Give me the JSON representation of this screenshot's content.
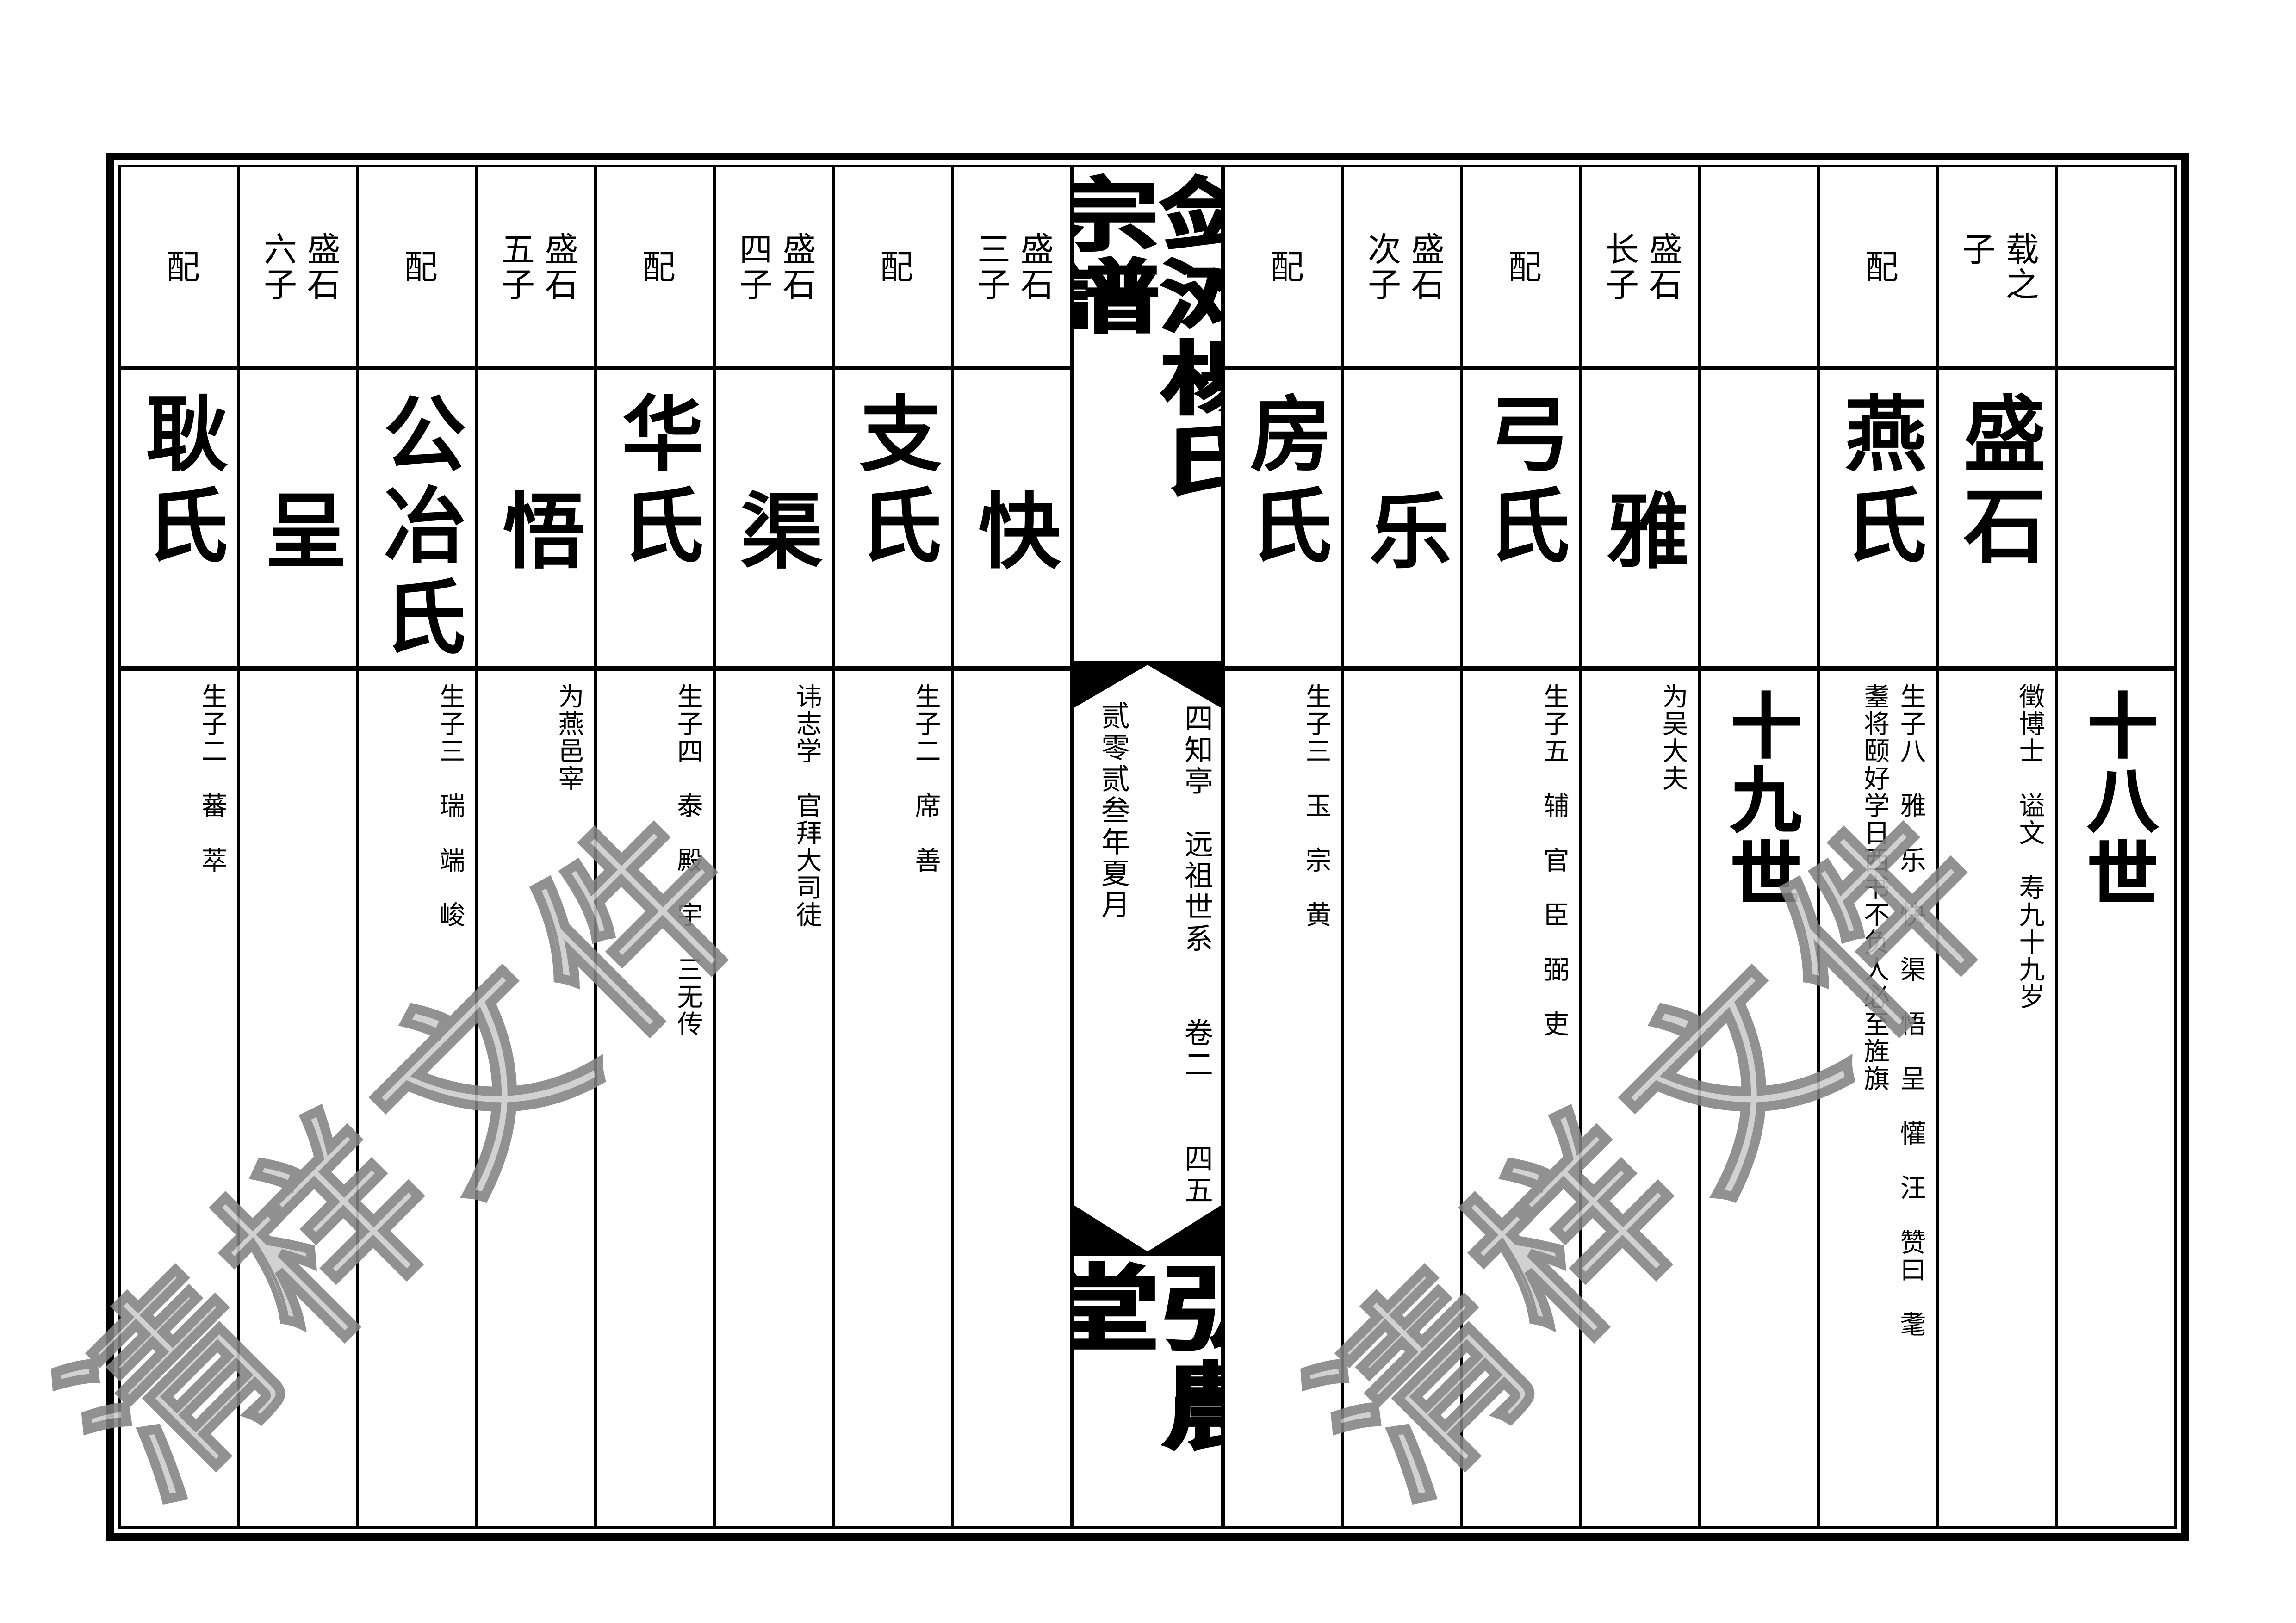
{
  "page": {
    "background": "#ffffff",
    "line_color": "#000000",
    "watermark_fill": "#cbcbcb",
    "watermark_stroke": "#828282"
  },
  "title": {
    "text": "剑滩楊氏宗譜",
    "hall": "弘農堂",
    "subtitle_right": "四知亭　远祖世系　　卷二　　四五",
    "subtitle_left": "贰零贰叁年夏月"
  },
  "watermark": {
    "text": "清样文件"
  },
  "columns": [
    {
      "header": "配",
      "name": "耿氏",
      "name_align": "top",
      "detail": "生子二　蕃　萃",
      "gen": ""
    },
    {
      "header": "盛石\n六子",
      "name": "呈",
      "name_align": "mid",
      "detail": "",
      "gen": ""
    },
    {
      "header": "配",
      "name": "公冶氏",
      "name_align": "top",
      "detail": "生子三　瑞　端　峻",
      "gen": ""
    },
    {
      "header": "盛石\n五子",
      "name": "悟",
      "name_align": "mid",
      "detail": "为燕邑宰",
      "gen": ""
    },
    {
      "header": "配",
      "name": "华氏",
      "name_align": "top",
      "detail": "生子四　泰　殿　宇　三无传",
      "gen": ""
    },
    {
      "header": "盛石\n四子",
      "name": "渠",
      "name_align": "mid",
      "detail": "讳志学　官拜大司徒",
      "gen": ""
    },
    {
      "header": "配",
      "name": "支氏",
      "name_align": "top",
      "detail": "生子二　席　善",
      "gen": ""
    },
    {
      "header": "盛石\n三子",
      "name": "快",
      "name_align": "mid",
      "detail": "",
      "gen": ""
    },
    {
      "header": "配",
      "name": "房氏",
      "name_align": "top",
      "detail": "生子三　玉　宗　黄",
      "gen": ""
    },
    {
      "header": "盛石\n次子",
      "name": "乐",
      "name_align": "mid",
      "detail": "",
      "gen": ""
    },
    {
      "header": "配",
      "name": "弓氏",
      "name_align": "top",
      "detail": "生子五　辅　官　臣　弼　吏",
      "gen": ""
    },
    {
      "header": "盛石\n长子",
      "name": "雅",
      "name_align": "mid",
      "detail": "为吴大夫",
      "gen": ""
    },
    {
      "header": "",
      "name": "",
      "name_align": "mid",
      "detail": "",
      "gen": "十九世"
    },
    {
      "header": "配",
      "name": "燕氏",
      "name_align": "top",
      "detail": "生子八　雅　乐　快　渠　悟　呈　懽　汪　赞曰　耄\n耋将颐好学日西书不负人必至旌旗",
      "gen": ""
    },
    {
      "header": "载之\n子",
      "name": "盛石",
      "name_align": "top",
      "detail": "徵博士　谥文　寿九十九岁",
      "gen": ""
    },
    {
      "header": "",
      "name": "",
      "name_align": "mid",
      "detail": "",
      "gen": "十八世"
    }
  ]
}
